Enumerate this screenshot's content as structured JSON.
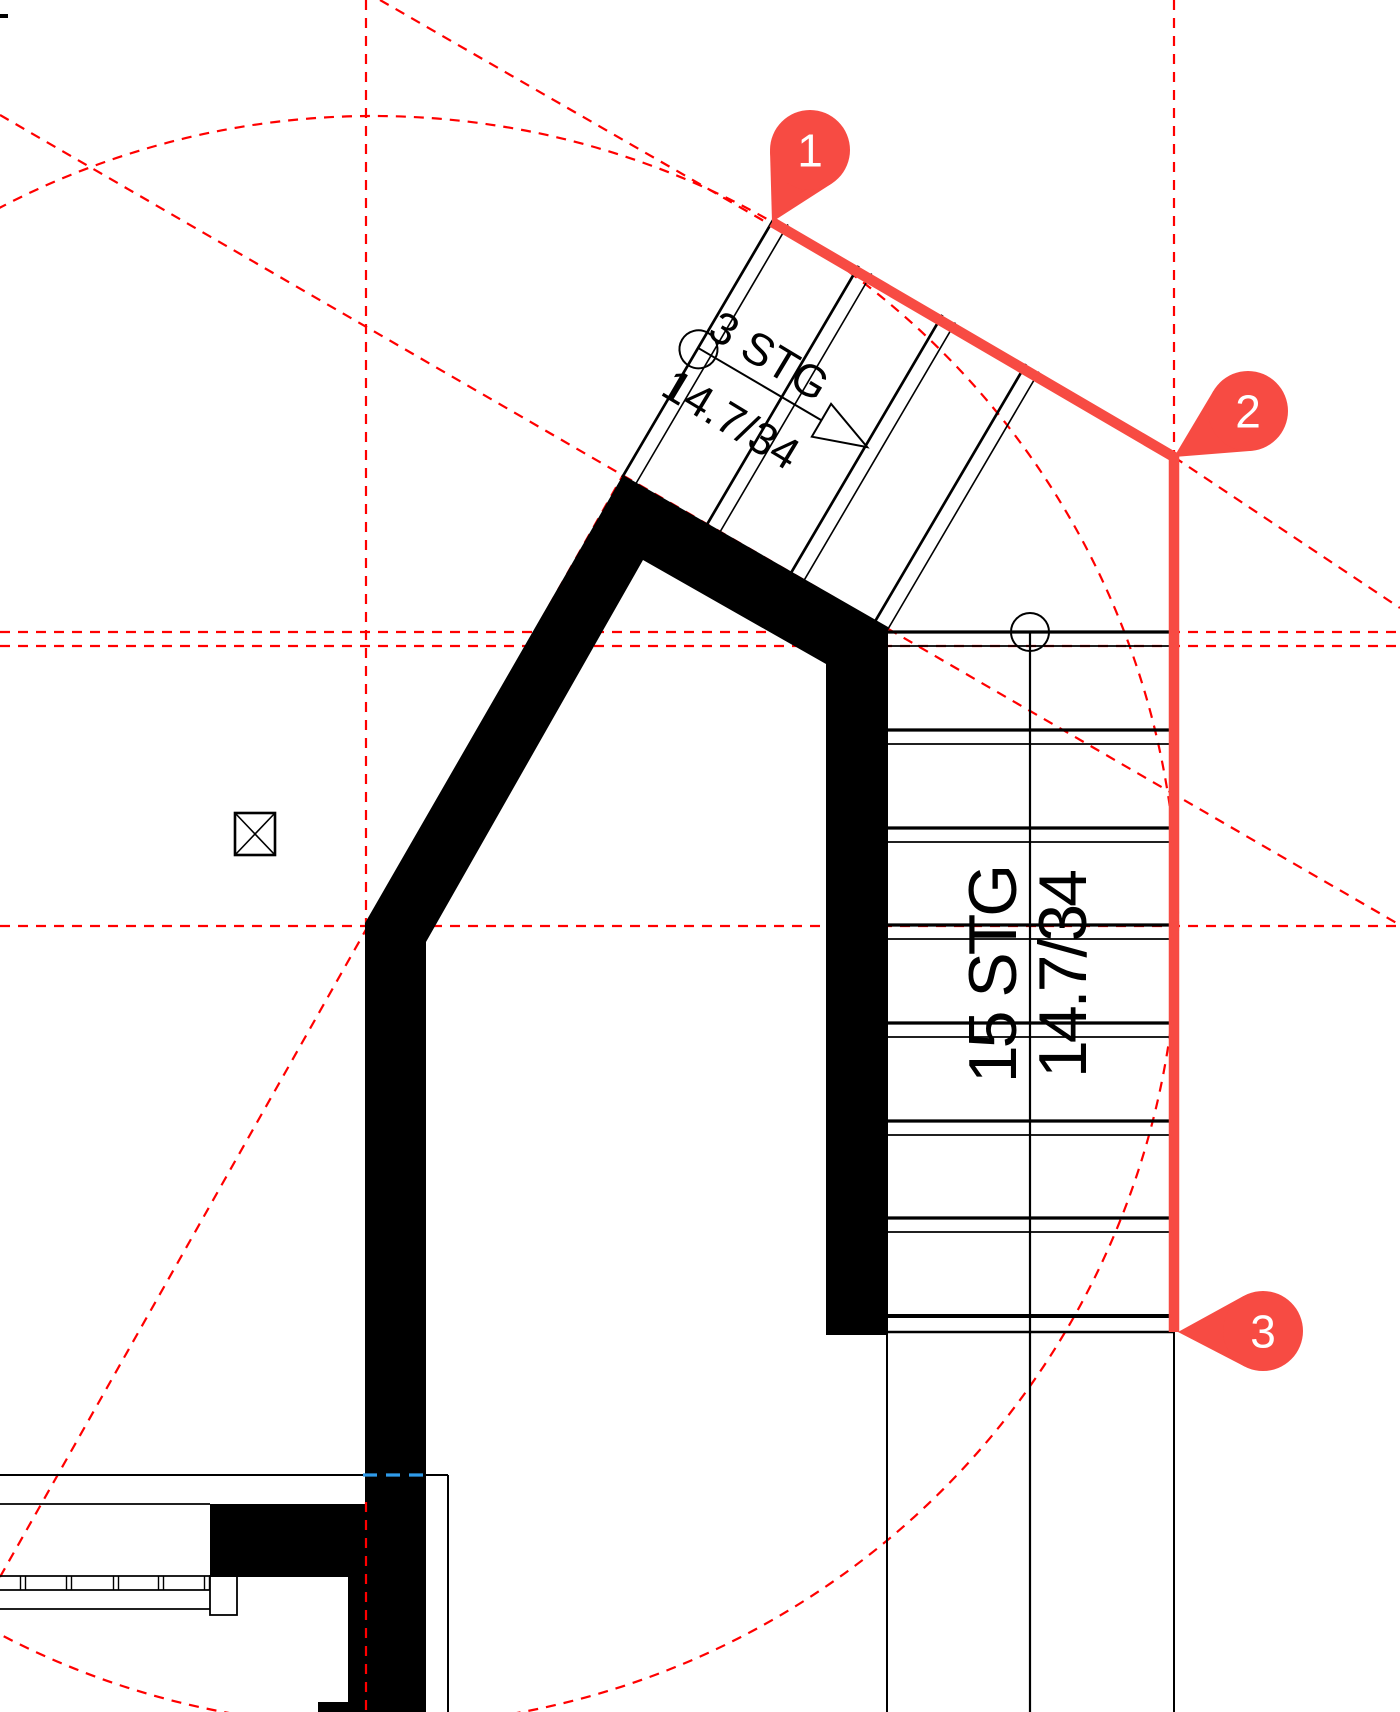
{
  "canvas": {
    "width": 1400,
    "height": 1712,
    "background": "#ffffff"
  },
  "colors": {
    "construction_red": "#ff0000",
    "annotation_red": "#f74b43",
    "hidden_edge_blue": "#2f9bea",
    "drawing_black": "#000000",
    "marker_text_white": "#ffffff"
  },
  "labels": {
    "upper_stair": {
      "line1": "3 STG",
      "line2": "14.7/34"
    },
    "lower_stair": {
      "line1": "15 STG",
      "line2": "14.7/34"
    }
  },
  "markers": [
    {
      "number": "1",
      "tip": [
        772,
        222
      ],
      "bulb": [
        810,
        150
      ],
      "r": 40
    },
    {
      "number": "2",
      "tip": [
        1174,
        457
      ],
      "bulb": [
        1248,
        411
      ],
      "r": 40
    },
    {
      "number": "3",
      "tip": [
        1178,
        1332
      ],
      "bulb": [
        1263,
        1331
      ],
      "r": 40
    }
  ],
  "annotation_polyline": {
    "points": [
      [
        772,
        222
      ],
      [
        1174,
        457
      ],
      [
        1174,
        1332
      ]
    ],
    "width": 10.5
  },
  "construction": {
    "dash": "10 8",
    "line_width": 2.2,
    "circle": {
      "cx": 373,
      "cy": 921,
      "r": 805
    },
    "lines": [
      {
        "name": "axis-upper-flight",
        "x1": 0,
        "y1": 115,
        "x2": 1400,
        "y2": 925
      },
      {
        "name": "axis-left-wall",
        "x1": 0,
        "y1": 1577,
        "x2": 623,
        "y2": 475
      },
      {
        "name": "axis-to-marker2",
        "x1": 380,
        "y1": 0,
        "x2": 1174,
        "y2": 457
      },
      {
        "name": "axis-from-marker2",
        "x1": 1174,
        "y1": 457,
        "x2": 1400,
        "y2": 608
      },
      {
        "name": "vertical-center",
        "x1": 366,
        "y1": 0,
        "x2": 366,
        "y2": 926
      },
      {
        "name": "vertical-right",
        "x1": 1174,
        "y1": 0,
        "x2": 1174,
        "y2": 460
      },
      {
        "name": "horizontal-top-a",
        "x1": 0,
        "y1": 632,
        "x2": 1400,
        "y2": 632
      },
      {
        "name": "horizontal-top-b",
        "x1": 0,
        "y1": 646,
        "x2": 1400,
        "y2": 646
      },
      {
        "name": "horizontal-center",
        "x1": 0,
        "y1": 926,
        "x2": 1400,
        "y2": 926
      }
    ],
    "overlay_segment": {
      "x1": 366,
      "y1": 1502,
      "x2": 366,
      "y2": 1712
    }
  },
  "walls": {
    "main_polygon": "M623,475 L888,627 L888,1335 L826,1335 L826,664 L643,560 L426,942 L426,1712 L318,1712 L318,1702 L348,1702 L348,1577 L210,1577 L210,1504 L365,1504 L365,923 Z",
    "corner_tick": {
      "x": 0,
      "y": 14,
      "w": 8,
      "h": 4
    }
  },
  "lower_stair": {
    "x1": 887,
    "x2": 1175,
    "tread_pairs": [
      632,
      730,
      828,
      925,
      1023,
      1121,
      1218
    ],
    "pair_gap": 14,
    "bottom_thick": 1316,
    "bottom_thin": 1332,
    "center_line_x": 1030,
    "right_line_x": 1174,
    "lines_bottom_y": 1712,
    "start_circle": {
      "cx": 1030,
      "cy": 632,
      "r": 19
    }
  },
  "upper_stair": {
    "origin": [
      772,
      222
    ],
    "angle_deg": 30.4,
    "tread_positions": [
      0,
      97,
      194,
      291
    ],
    "pair_gap": 15,
    "tread_from": -6,
    "tread_to": 296,
    "walkline": {
      "y": 146,
      "x1": 1,
      "x2": 196
    },
    "start_circle": {
      "cx": 1,
      "cy": 147,
      "r": 19
    },
    "arrow": {
      "apex": [
        196,
        146
      ],
      "back_a": [
        143,
        127
      ],
      "back_b": [
        143,
        165
      ]
    }
  },
  "details": {
    "column_symbol": {
      "x": 235,
      "y": 813,
      "w": 40,
      "h": 42
    },
    "room_line_y": 1475,
    "room_line_right_x": 448,
    "hidden_edge": {
      "x1": 363,
      "y1": 1475,
      "x2": 427,
      "y2": 1475
    },
    "counter": {
      "top_y": 1504,
      "strip_top": 1576,
      "strip_bottom": 1590,
      "bottom_y": 1609,
      "right_x": 210,
      "end_box": {
        "x": 210,
        "y": 1576,
        "w": 27,
        "h": 39
      },
      "dividers": [
        23,
        69,
        116,
        161,
        207
      ]
    }
  }
}
